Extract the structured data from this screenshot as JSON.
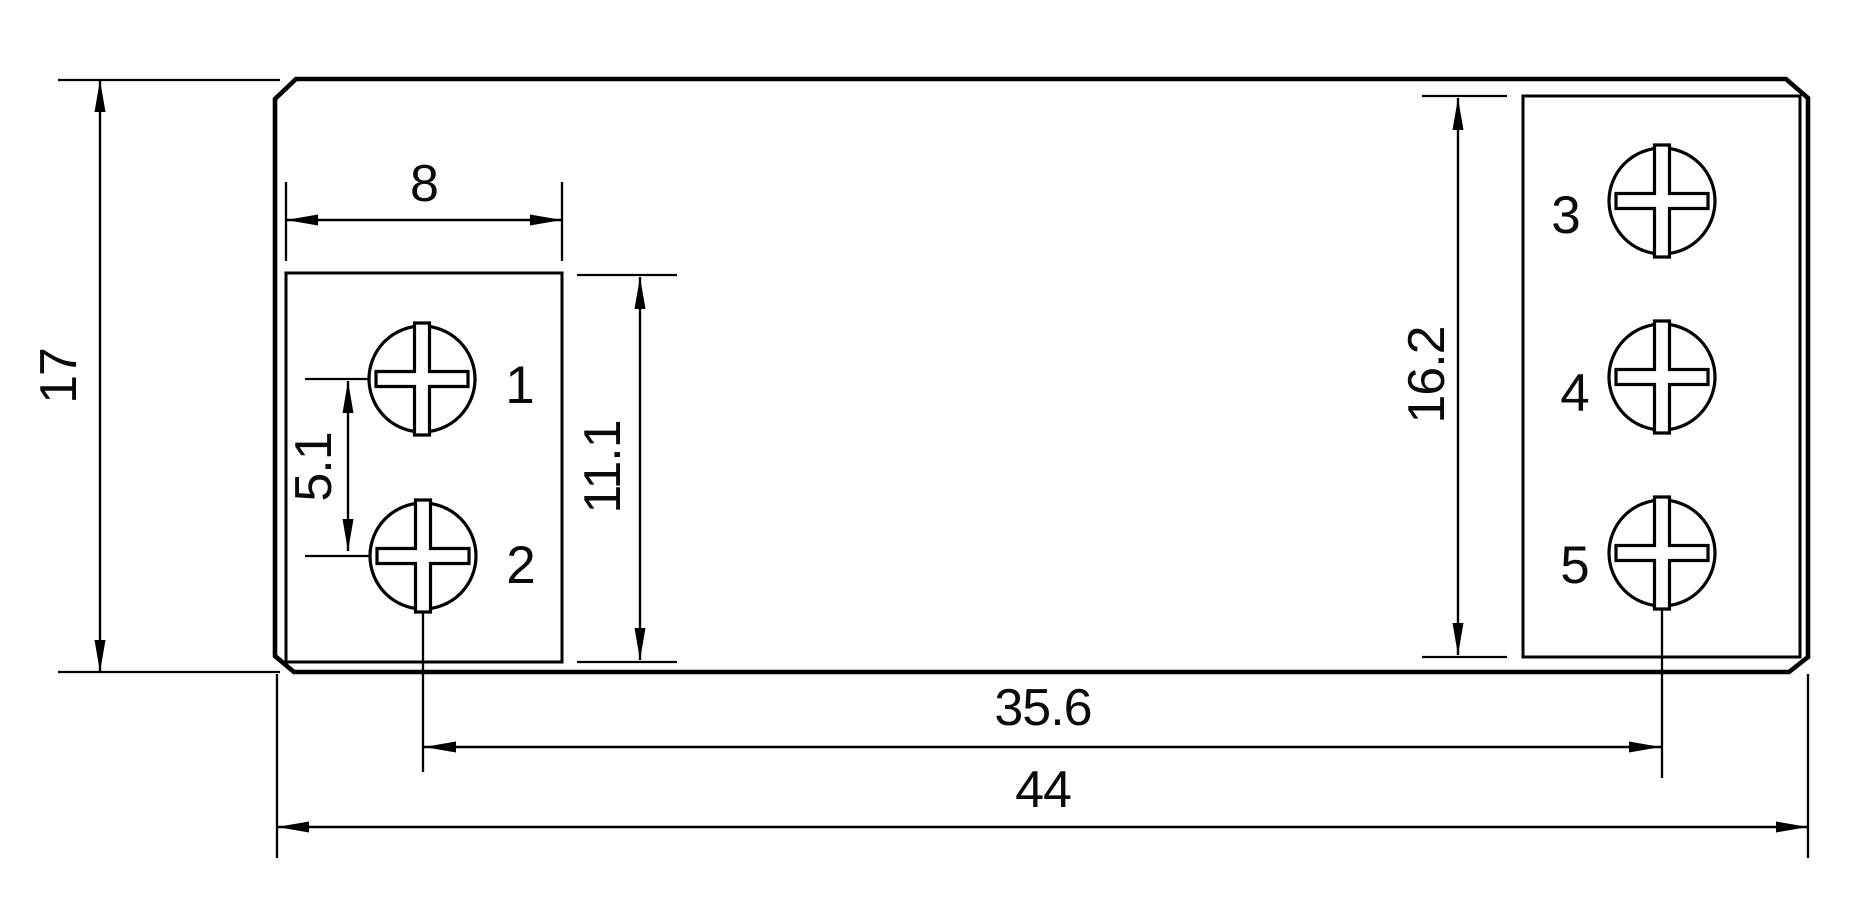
{
  "drawing": {
    "type": "technical-dimension-drawing",
    "dimensions": {
      "total_width": "44",
      "total_height": "17",
      "pad_width": "8",
      "pin_pitch": "5.1",
      "left_pad_height": "11.1",
      "right_pad_height": "16.2",
      "pin_span": "35.6"
    },
    "terminals": [
      "1",
      "2",
      "3",
      "4",
      "5"
    ]
  },
  "colors": {
    "line": "#0a0a0a",
    "terminal_label": "#ea1c22",
    "background": "#ffffff"
  }
}
